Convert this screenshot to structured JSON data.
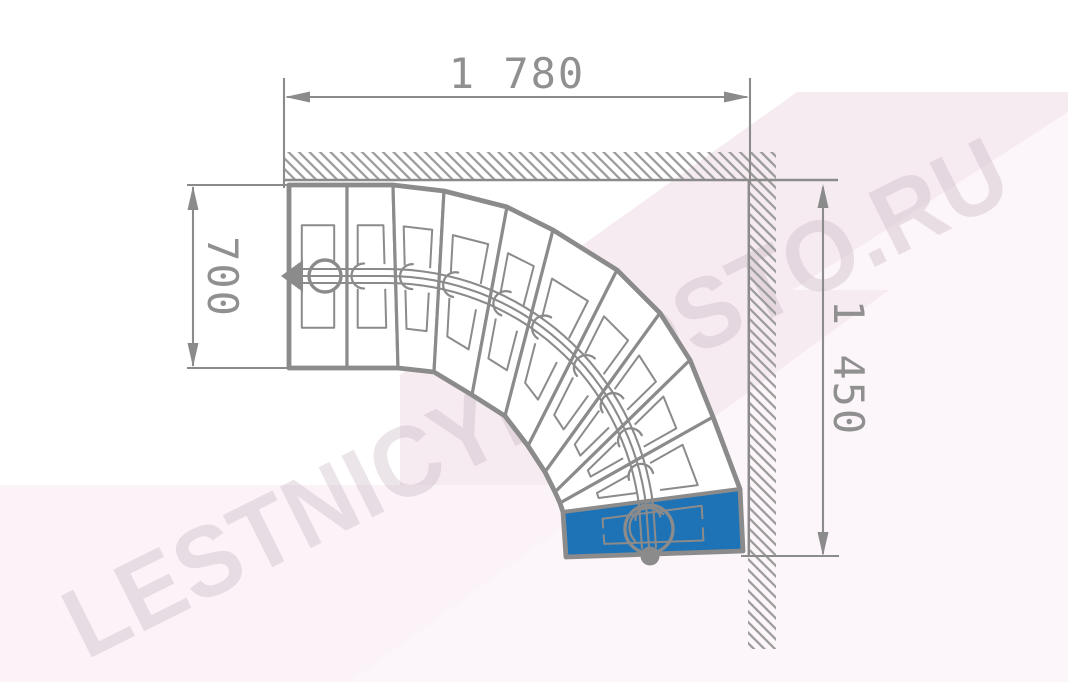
{
  "watermark": {
    "text": "LESTNICYPROSTO.RU"
  },
  "dimensions": {
    "top": {
      "label": "1 780"
    },
    "left": {
      "label": "700"
    },
    "right": {
      "label": "1 450"
    }
  },
  "stairs": {
    "type": "quarter-turn-winder-staircase-plan",
    "visible_step_count": 11,
    "highlighted_step_count": 1,
    "walk_line_markers": [
      "walk-direction-arrow",
      "walk-start-circle",
      "walk-end-circle",
      "walk-end-dot"
    ]
  },
  "colors": {
    "line": "#8b8b8b",
    "hatch": "#9d9d9d",
    "dim_text": "#909090",
    "step_fill": "#ffffff",
    "highlight_blue": "#1e72b6",
    "bg_pink": "#f7ebf2",
    "bg_pink_light": "#fbf3f8",
    "bg_pink_lighter": "#fcf5f9",
    "watermark": "#c5b2be"
  }
}
